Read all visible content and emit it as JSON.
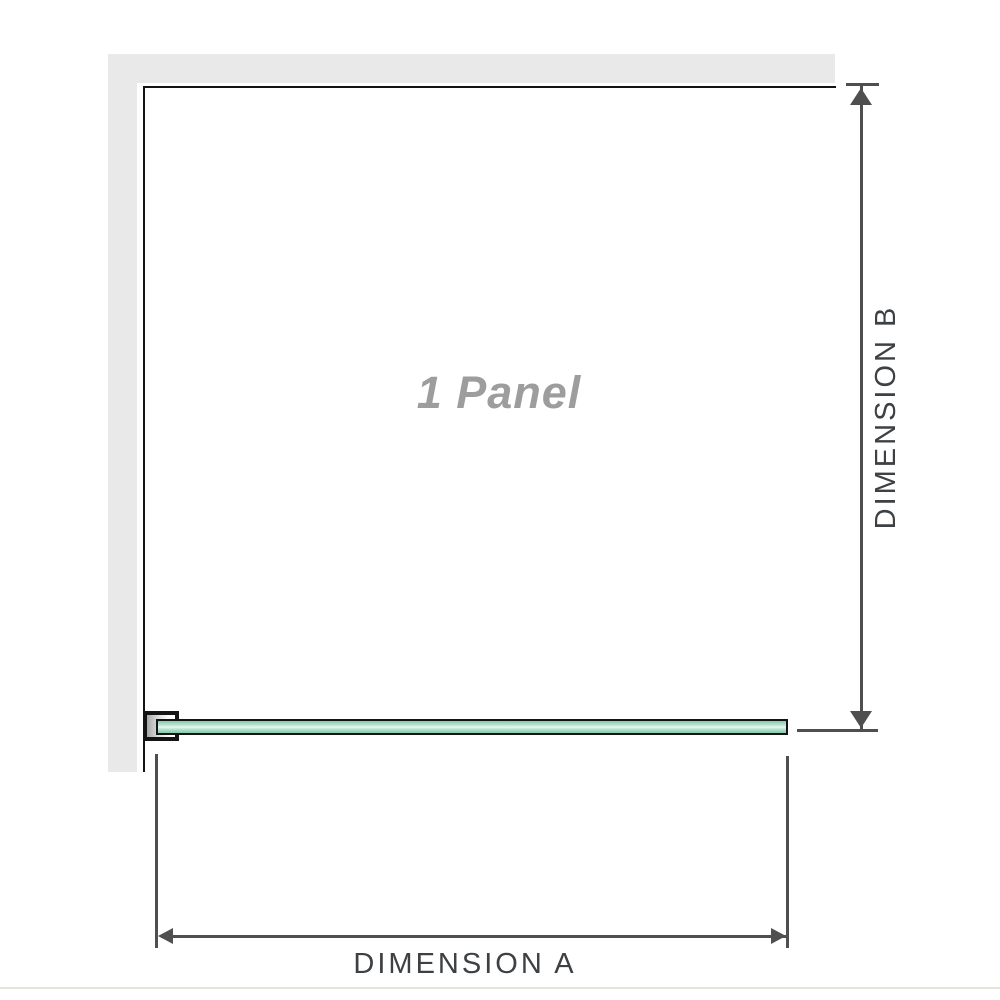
{
  "colors": {
    "wall": "#e9e9e9",
    "outline": "#141414",
    "arrow": "#4f4f4f",
    "label-text": "#3d4144",
    "panel-text": "#9d9d9d",
    "glass-dark": "#84cbaa",
    "glass-mid": "#b4e2cc",
    "glass-light": "#e9f8f0",
    "bracket-shadow": "#a9a9a9",
    "separator": "#e7e4df"
  },
  "diagram": {
    "panel": {
      "label": "1 Panel"
    },
    "dimension_a": {
      "label": "DIMENSION A"
    },
    "dimension_b": {
      "label": "DIMENSION B"
    }
  }
}
